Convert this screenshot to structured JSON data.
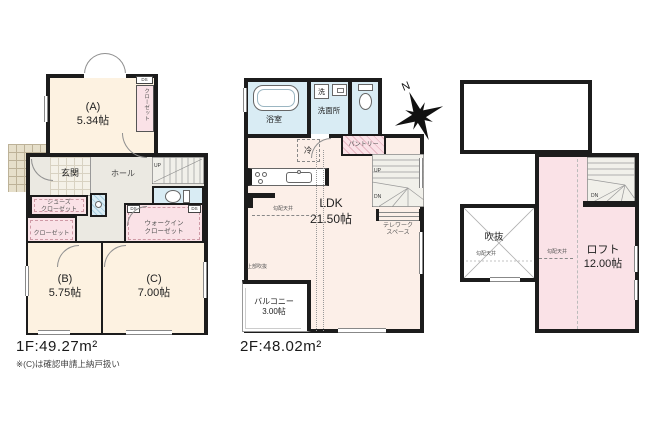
{
  "plan": {
    "f1": {
      "title": "1F:49.27m²",
      "note": "※(C)は確認申請上納戸扱い",
      "room_a": "(A)\n5.34帖",
      "room_b": "(B)\n5.75帖",
      "room_c": "(C)\n7.00帖",
      "closet_vertical": "クローゼット",
      "genkan": "玄関",
      "hall": "ホール",
      "shoes_closet": "シューズ\nクローゼット",
      "closet": "クローゼット",
      "walkin_closet": "ウォークイン\nクローゼット",
      "up": "UP",
      "ds": "DS"
    },
    "f2": {
      "title": "2F:48.02m²",
      "bath": "浴室",
      "laundry": "洗",
      "washroom": "洗面所",
      "fridge": "冷",
      "pantry": "パントリー",
      "ldk": "LDK\n21.50帖",
      "telework": "テレワーク\nスペース",
      "balcony": "バルコニー\n3.00帖",
      "sloped_ceiling": "勾配天井",
      "open_above": "上部吹抜",
      "up": "UP",
      "dn": "DN",
      "north": "N"
    },
    "loft": {
      "void": "吹抜",
      "room": "ロフト\n12.00帖",
      "sloped_ceiling": "勾配天井",
      "dn": "DN"
    },
    "colors": {
      "wall": "#1c1c1c",
      "room_cream": "#fdf2e1",
      "room_pink": "#fae2e7",
      "room_blue": "#d9ecf4",
      "hall_gray": "#ebe9e2",
      "ldk_cream": "#fcefe8",
      "stair_gray": "#f1f0ea",
      "tile_beige": "#e6dfca"
    }
  }
}
